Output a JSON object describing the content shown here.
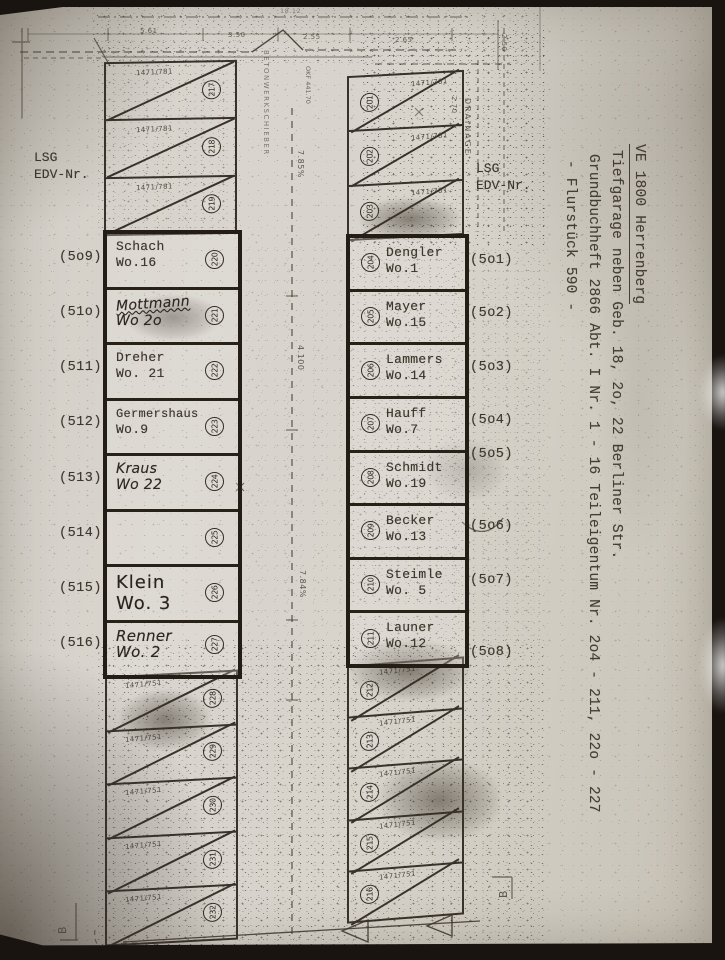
{
  "headers": {
    "left": {
      "line1": "LSG",
      "line2": "EDV-Nr."
    },
    "right": {
      "line1": "LSG",
      "line2": "EDV-Nr."
    }
  },
  "left_column": {
    "top": [
      {
        "parcel": "1471/781",
        "num": "217"
      },
      {
        "parcel": "1471/781",
        "num": "218"
      },
      {
        "parcel": "1471/781",
        "num": "219"
      }
    ],
    "main": [
      {
        "edv": "(5o9)",
        "name": "Schach",
        "wo": "Wo.16",
        "num": "220"
      },
      {
        "edv": "(51o)",
        "name": "Mottmann",
        "wo": "Wo 2o",
        "num": "221"
      },
      {
        "edv": "(511)",
        "name": "Dreher",
        "wo": "Wo. 21",
        "num": "222"
      },
      {
        "edv": "(512)",
        "name": "Germershaus",
        "wo": "Wo.9",
        "num": "223"
      },
      {
        "edv": "(513)",
        "name": "Kraus",
        "wo": "Wo 22",
        "num": "224"
      },
      {
        "edv": "(514)",
        "name": "",
        "wo": "",
        "num": "225"
      },
      {
        "edv": "(515)",
        "name": "Klein",
        "wo": "Wo. 3",
        "num": "226"
      },
      {
        "edv": "(516)",
        "name": "Renner",
        "wo": "Wo. 2",
        "num": "227"
      }
    ],
    "bottom": [
      {
        "parcel": "1471/751",
        "num": "228"
      },
      {
        "parcel": "1471/751",
        "num": "229"
      },
      {
        "parcel": "1471/751",
        "num": "230"
      },
      {
        "parcel": "1471/751",
        "num": "231"
      },
      {
        "parcel": "1471/751",
        "num": "232"
      }
    ]
  },
  "right_column": {
    "top": [
      {
        "parcel": "1471/781",
        "num": "201"
      },
      {
        "parcel": "1471/781",
        "num": "202"
      },
      {
        "parcel": "1471/781",
        "num": "203"
      }
    ],
    "main": [
      {
        "edv": "(5o1)",
        "name": "Dengler",
        "wo": "Wo.1",
        "num": "204"
      },
      {
        "edv": "(5o2)",
        "name": "Mayer",
        "wo": "Wo.15",
        "num": "205"
      },
      {
        "edv": "(5o3)",
        "name": "Lammers",
        "wo": "Wo.14",
        "num": "206"
      },
      {
        "edv": "(5o4)",
        "name": "Hauff",
        "wo": "Wo.7",
        "num": "207"
      },
      {
        "edv": "(5o5)",
        "name": "Schmidt",
        "wo": "Wo.19",
        "num": "208"
      },
      {
        "edv": "(5o6)",
        "name": "Becker",
        "wo": "Wo.13",
        "num": "209"
      },
      {
        "edv": "(5o7)",
        "name": "Steimle",
        "wo": "Wo. 5",
        "num": "210"
      },
      {
        "edv": "(5o8)",
        "name": "Launer",
        "wo": "Wo.12",
        "num": "211"
      }
    ],
    "bottom": [
      {
        "parcel": "1471/751",
        "num": "212"
      },
      {
        "parcel": "1471/751",
        "num": "213"
      },
      {
        "parcel": "1471/751",
        "num": "214"
      },
      {
        "parcel": "1471/751",
        "num": "215"
      },
      {
        "parcel": "1471/751",
        "num": "216"
      }
    ]
  },
  "side_note": {
    "line1": "VE 1800 Herrenberg",
    "line2": "Tiefgarage neben Geb. 18, 2o, 22 Berliner Str.",
    "line3": "Grundbuchheft 2866 Abt. I Nr. 1 - 16  Teileigentum Nr. 2o4 - 211, 22o - 227",
    "line4": "- Flurstück 590 -"
  },
  "annotations": {
    "drainage": "DRAINAGE",
    "ramp_label": "BETONWERKSCHIEBER",
    "okf_line1": "OKF",
    "okf_line2": "441.70",
    "slope_top": "7.85%",
    "corridor_dim": "4.100",
    "slope_bottom": "7.84%",
    "dim_1812": "18.12",
    "dim_561": "5.61",
    "dim_350": "3.50",
    "dim_255": "2.55",
    "dim_265": "2.65",
    "dim_250": "2.50",
    "dim_270": "2.70",
    "section_b_left": "B",
    "section_b_right": "B"
  },
  "colors": {
    "ink": "#39322a",
    "paper": "#d8d4cc",
    "marker": "#241d15"
  }
}
